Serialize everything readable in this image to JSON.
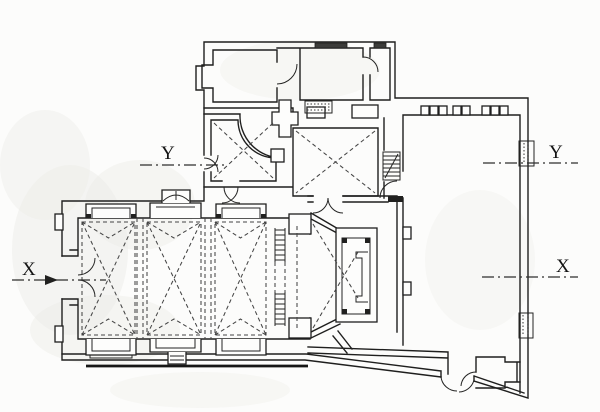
{
  "drawing": {
    "section_labels": {
      "y_left": "Y",
      "y_right": "Y",
      "x_left": "X",
      "x_right": "X"
    }
  },
  "colors": {
    "background": "#fcfcfb",
    "ink": "#1f1f1e",
    "dashed_lines": "#454545",
    "smudge": "#ebebe7"
  }
}
